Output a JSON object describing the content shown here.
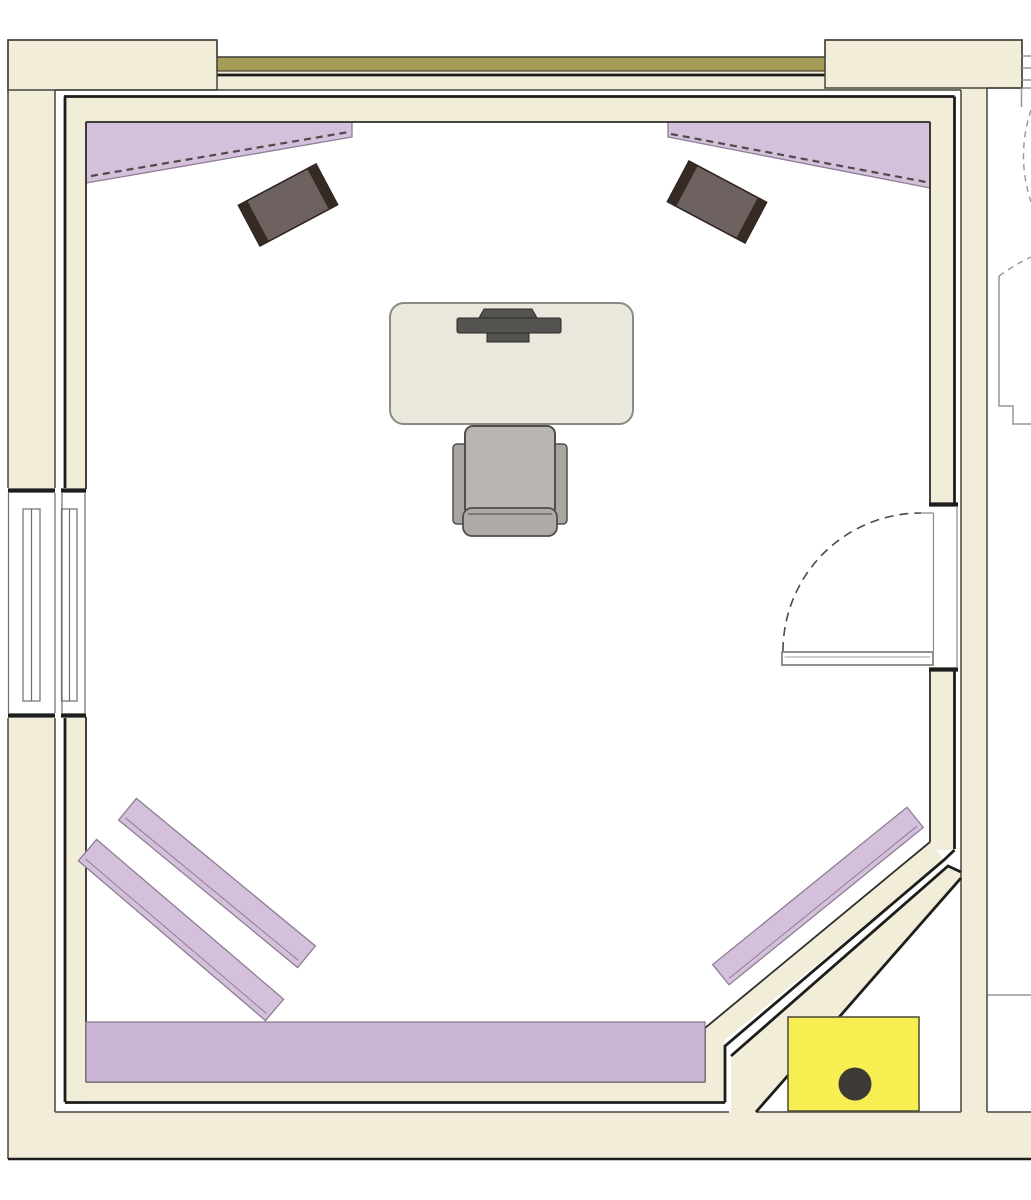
{
  "page": {
    "kind": "architectural-floor-plan",
    "width_px": 1031,
    "height_px": 1200,
    "visible_text": ""
  },
  "colors": {
    "wall_fill": "#f2edd8",
    "wall_outline": "#45443f",
    "inner_line": "#1d1d1b",
    "room_face": "#2e2e2b",
    "olive_fill": "#a59c55",
    "olive_outline": "#45432f",
    "purple_fill": "#d5c0db",
    "purple_band": "#c9b4d4",
    "purple_outline": "#8e7d94",
    "hatch_line": "#4e4a48",
    "speaker_body": "#6e6260",
    "speaker_cap": "#352b24",
    "speaker_outline": "#29211b",
    "desk_fill": "#eae8dc",
    "desk_outline": "#8b8b84",
    "monitor_fill": "#54534f",
    "monitor_outline": "#2b2a27",
    "chair_seat": "#b9b6b1",
    "chair_arm": "#a9a6a1",
    "chair_back": "#aeaba6",
    "chair_outline": "#504e4a",
    "door_line": "#4a4a46",
    "jamb_line": "#8a8a84",
    "leaf_fill": "#ffffff",
    "leaf_line": "#76756e",
    "leaf_inner": "#b3b2aa",
    "window_line": "#6e6e68",
    "neighbor_line": "#97968f",
    "box_fill": "#f7ef52",
    "box_outline": "#55523e",
    "dot_fill": "#3d3a36",
    "gap_white": "#ffffff"
  },
  "objects": {
    "room": "square room with chamfered bottom-right corner, double-wall construction with air gap",
    "acoustic_wedge_count": 2,
    "speaker_count": 2,
    "diffuser_bar_count": 2,
    "corner_panel_count": 1,
    "bass_trap_band_count": 1,
    "desk_count": 1,
    "monitor_count": 1,
    "chair_count": 1,
    "door_count": 1,
    "window_count": 1,
    "equipment_box_count": 1
  }
}
